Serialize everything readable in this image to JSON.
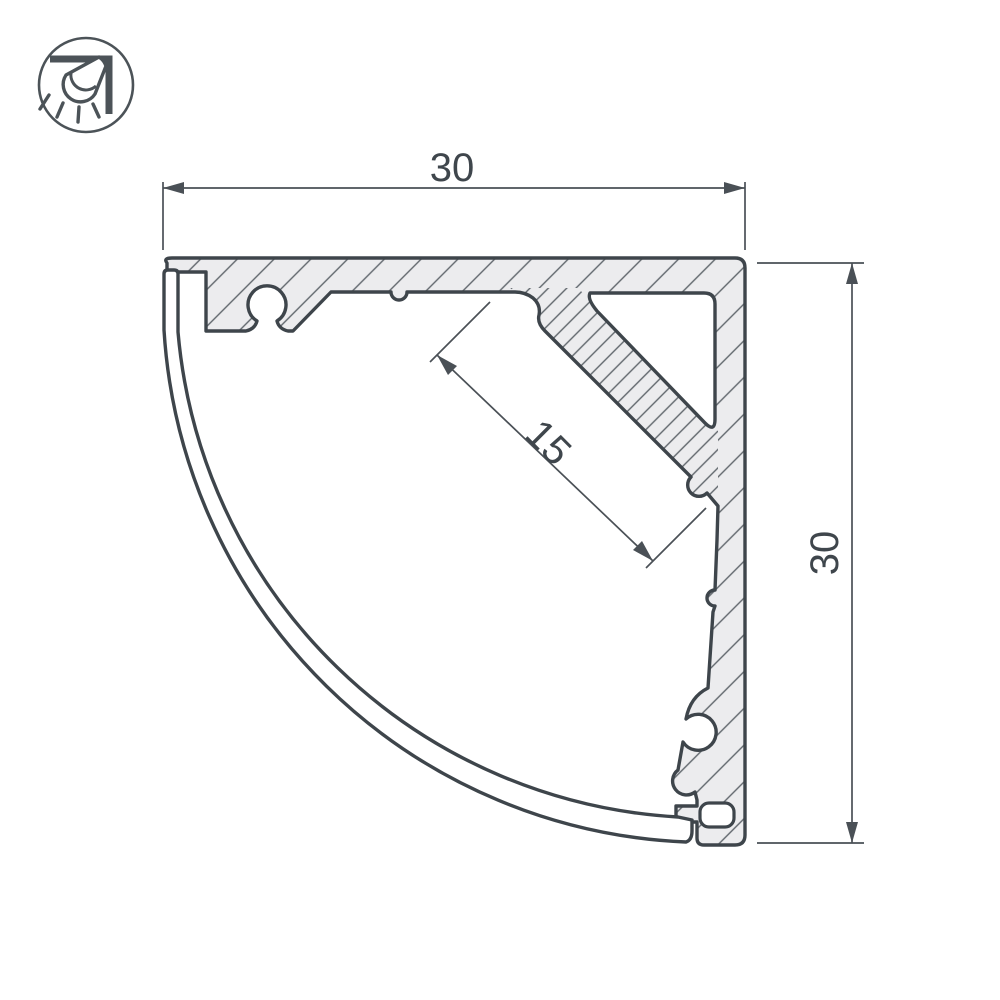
{
  "drawing": {
    "title": "corner-led-profile-cross-section",
    "type": "technical-drawing"
  },
  "icon_badge": {
    "name": "corner-mounted-light-icon"
  },
  "dimension_labels": {
    "top_width": "30",
    "right_height": "30",
    "led_shelf_width": "15"
  },
  "colors": {
    "outline": "#3e454b",
    "dimension": "#4a5056",
    "hatch_fill": "#ececee",
    "hatch_line": "#60666c",
    "background": "#ffffff"
  }
}
